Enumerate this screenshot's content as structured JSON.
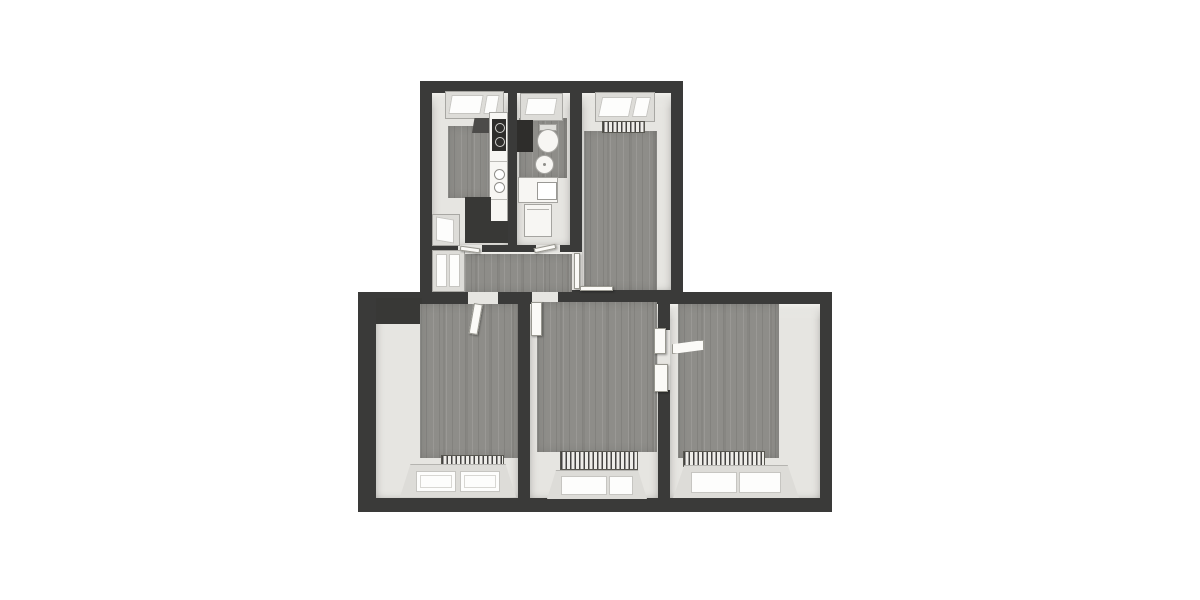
{
  "scene": {
    "description": "3D top-down floor plan render of an apartment, no text labels",
    "background": "#ffffff",
    "palette": {
      "wall": "#3a3a39",
      "wall_dark": "#2e2d2b",
      "floor_light": "#e6e5e1",
      "floor_bright": "#f2f1ed",
      "floor_wood": "#8e8d89",
      "fixture": "#f7f6f3",
      "frame_line": "#a8a7a3",
      "pane": "#fdfdfc",
      "cooktop": "#2e2d2b"
    }
  },
  "rooms": [
    {
      "id": "kitchen",
      "fixtures": [
        "north-window",
        "extractor-hood",
        "counter-run",
        "cooktop",
        "west-window",
        "masonry-block",
        "wood-floor"
      ]
    },
    {
      "id": "bathroom",
      "fixtures": [
        "north-window",
        "duct",
        "toilet",
        "washbasin",
        "vanity",
        "washing-machine",
        "wood-floor"
      ]
    },
    {
      "id": "room-top-right",
      "fixtures": [
        "north-window",
        "radiator",
        "wood-floor",
        "door-to-hallway",
        "threshold"
      ]
    },
    {
      "id": "hallway",
      "fixtures": [
        "west-window",
        "wood-floor",
        "kitchen-door-leaf",
        "bathroom-door-leaf"
      ]
    },
    {
      "id": "room-bottom-left",
      "fixtures": [
        "entry-door-leaf",
        "masonry-block",
        "wood-floor",
        "radiator",
        "south-window"
      ]
    },
    {
      "id": "room-bottom-middle",
      "fixtures": [
        "entry-door-leaf",
        "connecting-door-jambs",
        "wood-floor",
        "radiator",
        "south-window"
      ]
    },
    {
      "id": "room-bottom-right",
      "fixtures": [
        "connecting-door-leaf",
        "wood-floor",
        "radiator",
        "south-window"
      ]
    }
  ]
}
